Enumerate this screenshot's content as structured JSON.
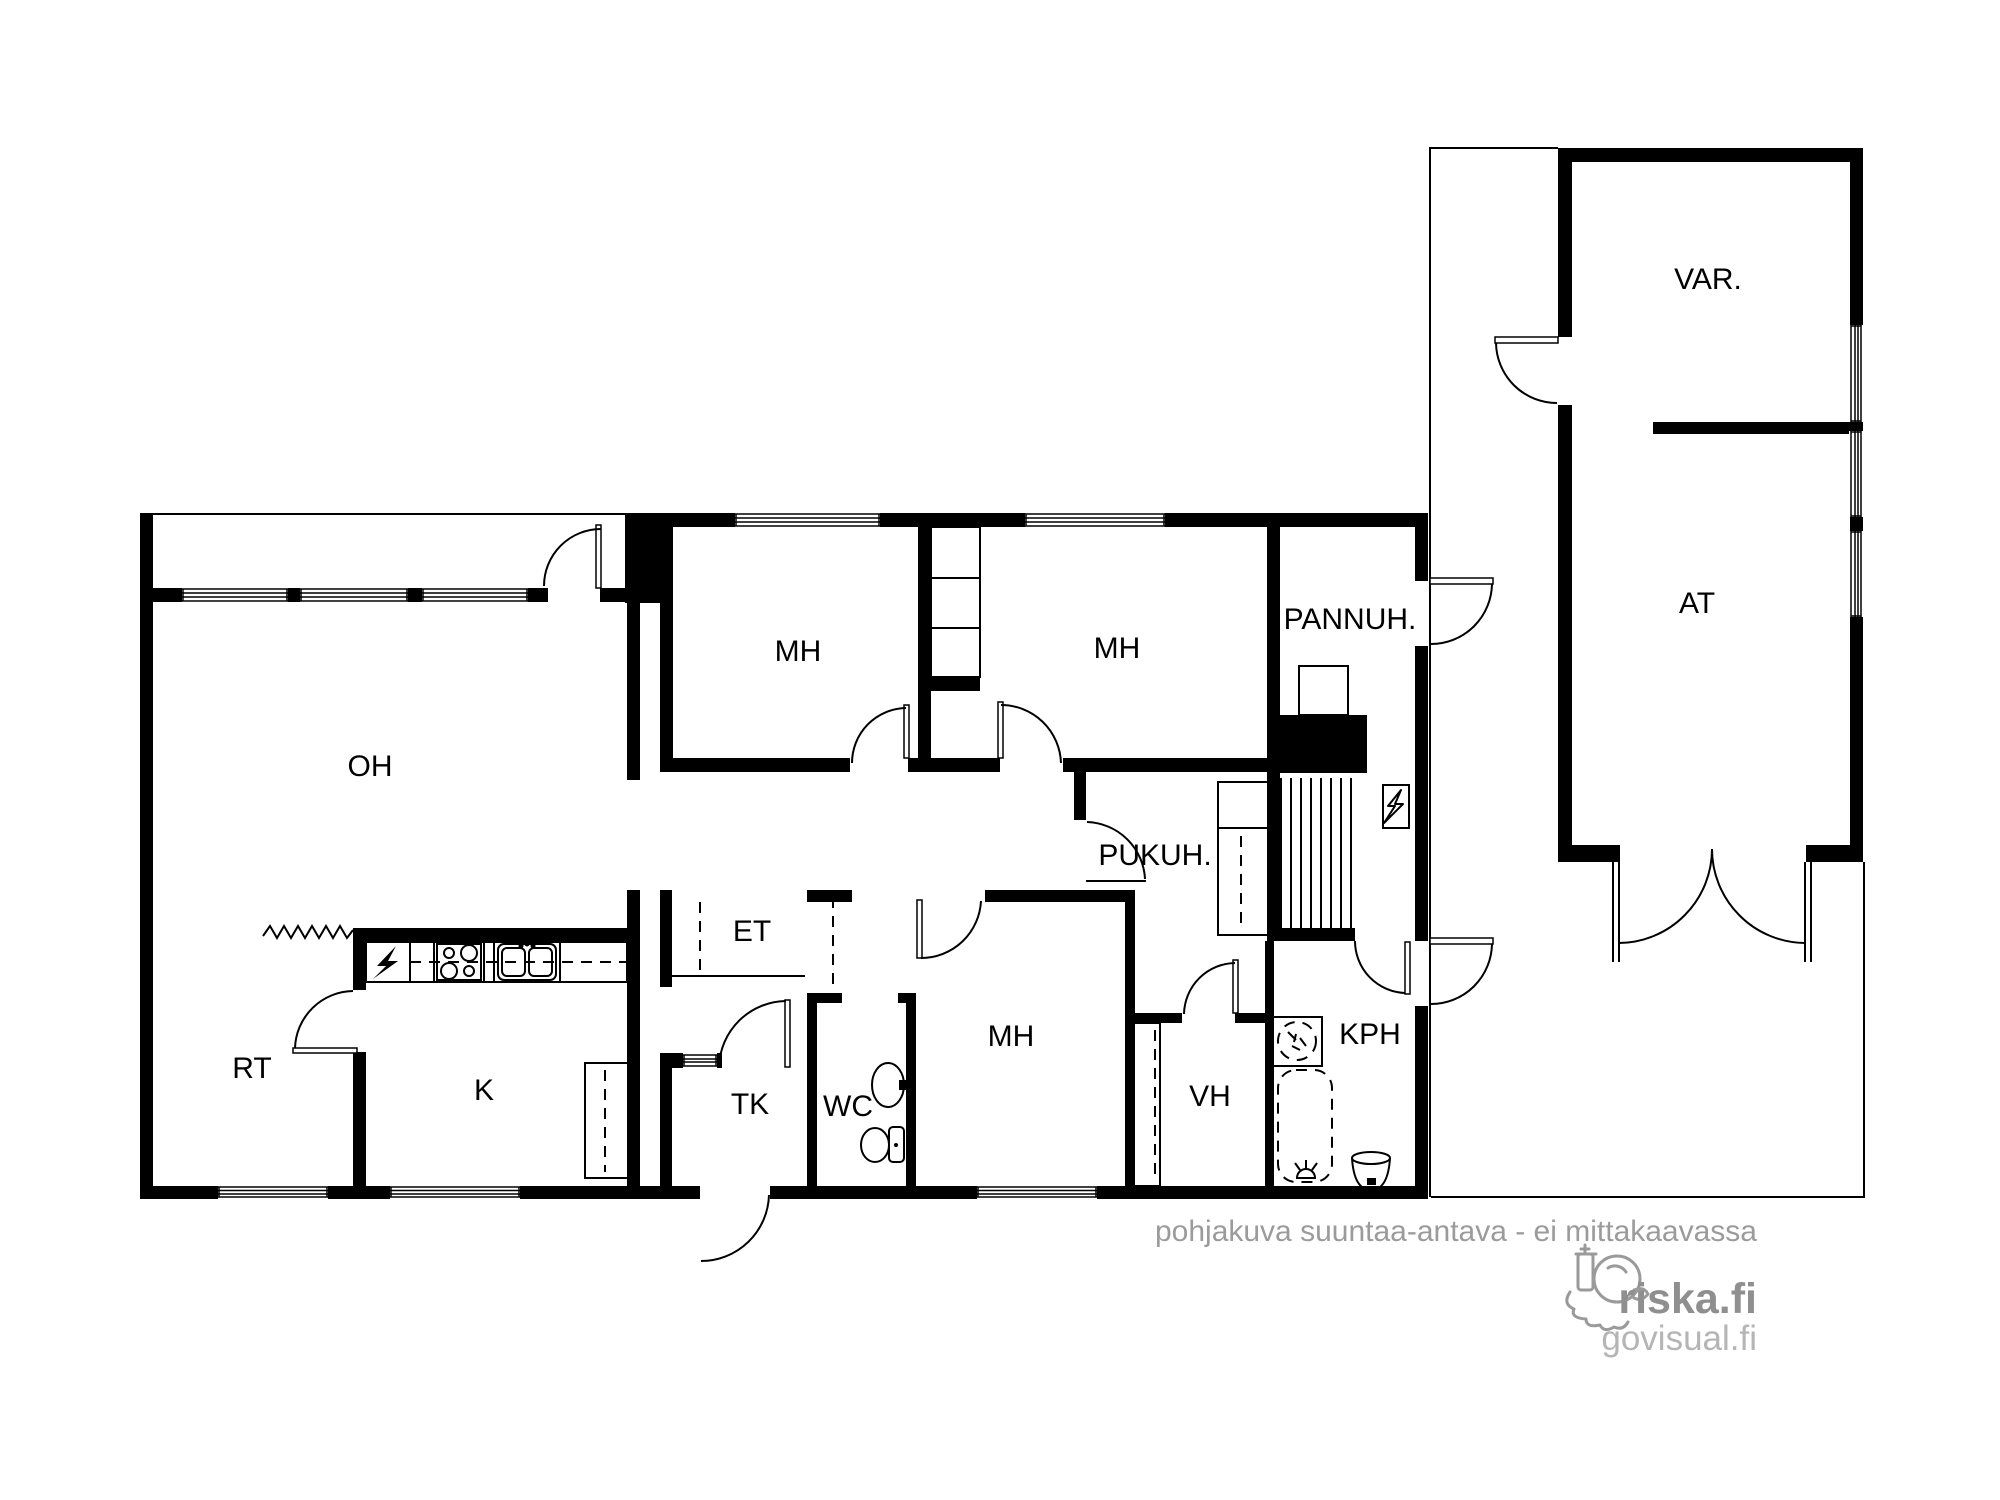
{
  "plan": {
    "rooms": {
      "oh": {
        "label": "OH"
      },
      "rt": {
        "label": "RT"
      },
      "k": {
        "label": "K"
      },
      "et": {
        "label": "ET"
      },
      "tk": {
        "label": "TK"
      },
      "wc": {
        "label": "WC"
      },
      "mh_top_left": {
        "label": "MH"
      },
      "mh_top_right": {
        "label": "MH"
      },
      "mh_bottom": {
        "label": "MH"
      },
      "pannuh": {
        "label": "PANNUH."
      },
      "pukuh": {
        "label": "PUKUH."
      },
      "vh": {
        "label": "VH"
      },
      "kph": {
        "label": "KPH"
      },
      "var": {
        "label": "VAR."
      },
      "at": {
        "label": "AT"
      }
    },
    "colors": {
      "wall": "#000000",
      "background": "#ffffff",
      "disclaimer_text": "#9b9b9b",
      "brand_primary_text": "#8f8f8f",
      "brand_secondary_text": "#b5b5b5"
    }
  },
  "footer": {
    "disclaimer": "pohjakuva suuntaa-antava - ei mittakaavassa",
    "brand_primary": "riska.fi",
    "brand_secondary": "govisual.fi"
  }
}
